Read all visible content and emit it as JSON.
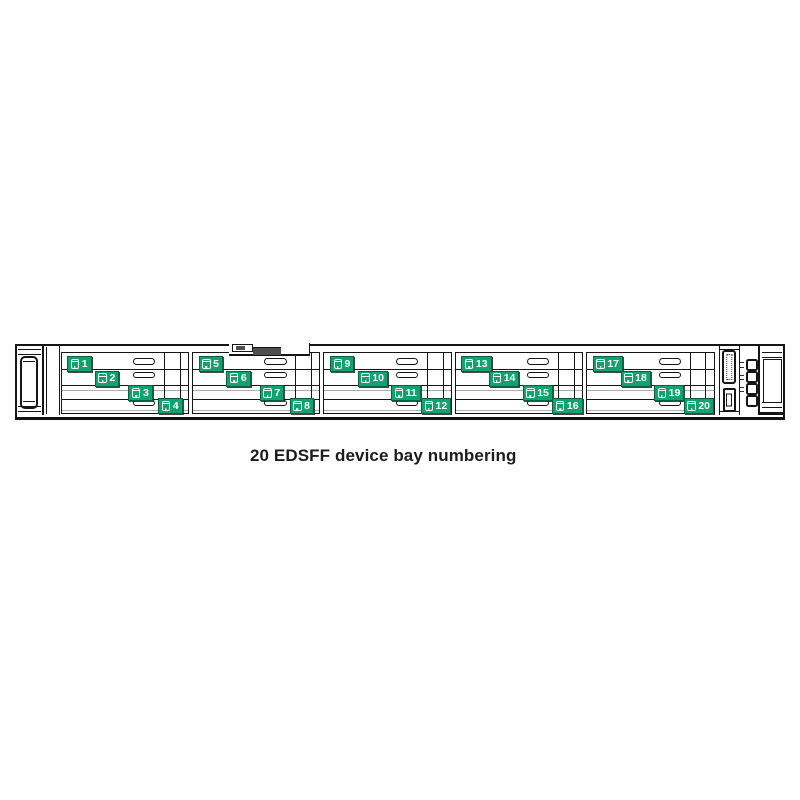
{
  "caption": "20 EDSFF device bay numbering",
  "colors": {
    "bay_label_green": "#10A370",
    "bay_label_text": "#FFFFFF",
    "line_black": "#151515",
    "shadow_gray": "#ADADAD",
    "recess_gray": "#4F4F4F"
  },
  "server_front": {
    "drive_groups": [
      {
        "bays": [
          {
            "number": "1"
          },
          {
            "number": "2"
          },
          {
            "number": "3"
          },
          {
            "number": "4"
          }
        ]
      },
      {
        "bays": [
          {
            "number": "5"
          },
          {
            "number": "6"
          },
          {
            "number": "7"
          },
          {
            "number": "8"
          }
        ]
      },
      {
        "bays": [
          {
            "number": "9"
          },
          {
            "number": "10"
          },
          {
            "number": "11"
          },
          {
            "number": "12"
          }
        ]
      },
      {
        "bays": [
          {
            "number": "13"
          },
          {
            "number": "14"
          },
          {
            "number": "15"
          },
          {
            "number": "16"
          }
        ]
      },
      {
        "bays": [
          {
            "number": "17"
          },
          {
            "number": "18"
          },
          {
            "number": "19"
          },
          {
            "number": "20"
          }
        ]
      }
    ],
    "front_io": {
      "ports": [
        {
          "icon": "display-port-icon"
        },
        {
          "icon": "usb-port-icon"
        }
      ],
      "indicators": [
        {
          "icon": "uid-led-icon"
        },
        {
          "icon": "health-led-icon"
        },
        {
          "icon": "nic-led-icon"
        },
        {
          "icon": "power-button-icon"
        }
      ]
    }
  }
}
